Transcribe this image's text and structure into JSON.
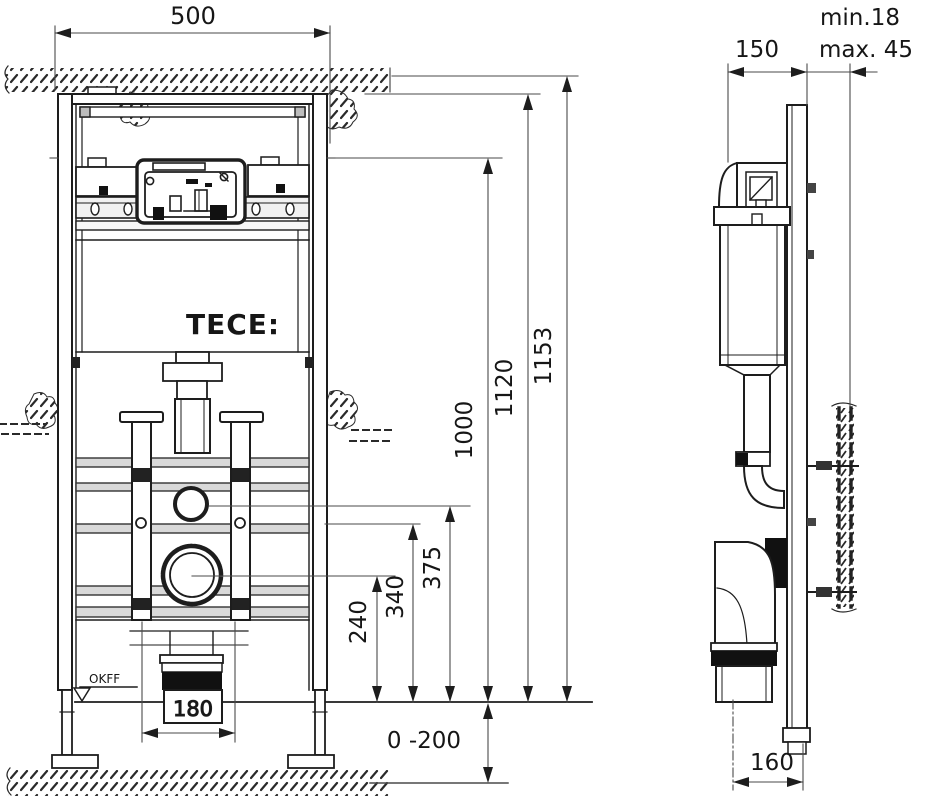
{
  "drawing": {
    "brand_logo": "TECE:",
    "ink_color": "#1d1d1d",
    "band_fill": "#d9d9d9",
    "front_view": {
      "width_top": "500",
      "height_total": "1153",
      "height_frame": "1120",
      "height_fixing": "1000",
      "height_supply": "375",
      "height_mid_rail": "340",
      "height_drain_center": "240",
      "bolt_spacing": "180",
      "floor_adjust_range": "0 -200",
      "floor_level_label": "OKFF"
    },
    "side_view": {
      "depth": "150",
      "wall_lining_min": "min.18",
      "wall_lining_max": "max. 45",
      "drain_offset": "160"
    }
  }
}
